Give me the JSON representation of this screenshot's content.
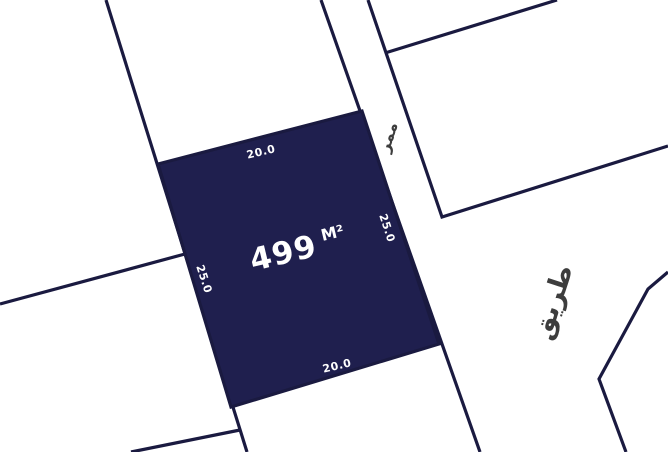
{
  "map": {
    "plot": {
      "area_value": "499",
      "area_unit": "M²",
      "dimensions": {
        "top": "20.0",
        "right": "25.0",
        "bottom": "20.0",
        "left": "25.0"
      }
    },
    "street_labels": {
      "passage": "ممر",
      "road": "طريق"
    },
    "colors": {
      "background": "#ffffff",
      "plot_fill": "#1f1f4e",
      "boundary_line": "#1a1a40",
      "dimension_text": "#ffffff",
      "street_text": "#3d3d3d"
    }
  }
}
